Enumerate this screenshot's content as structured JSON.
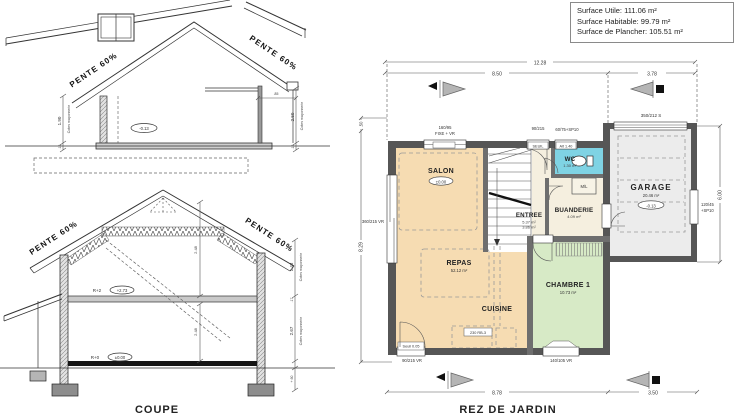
{
  "info_box": {
    "line1": "Surface Utile: 111.06 m²",
    "line2": "Surface Habitable: 99.79 m²",
    "line3": "Surface de Plancher: 105.51 m²"
  },
  "coupe": {
    "title": "COUPE",
    "pente": "PENTE 60%",
    "top": {
      "level": "-0.13",
      "d190": "1.90",
      "d12": ".12",
      "d250": "2.50",
      "d85": ".85",
      "cotes": "Cotes maçonnerie"
    },
    "bot": {
      "r2": "R+2",
      "r2v": "+2.73",
      "r0": "R+0",
      "r0v": "±0.00",
      "d143": "1.43",
      "d267": "2.67",
      "d17": ".17",
      "d60": "+.60",
      "d248": "2.48",
      "cotes": "Cotes maçonnerie"
    }
  },
  "plan": {
    "title": "REZ DE JARDIN",
    "dims": {
      "top_total": "12.28",
      "top_left": "8.50",
      "top_right": "3.78",
      "bottom_left": "8.78",
      "bottom_right": "3.50",
      "left_height": "8.29",
      "left_small": ".50",
      "right_height": "6.00"
    },
    "rooms": {
      "salon": {
        "label": "SALON",
        "level": "±0.00"
      },
      "repas": {
        "label": "REPAS",
        "area": "52.12 m²"
      },
      "cuisine": {
        "label": "CUISINE"
      },
      "entree": {
        "label": "ENTREE",
        "area1": "5.37 m²",
        "area2": "3.86 m²"
      },
      "wc": {
        "label": "WC",
        "area": "1.30 m²"
      },
      "buanderie": {
        "label": "BUANDERIE",
        "area": "4.09 m²"
      },
      "chambre": {
        "label": "CHAMBRE 1",
        "area": "10.73 m²"
      },
      "garage": {
        "label": "GARAGE",
        "area": "20.46 m²",
        "level": "-0.13"
      }
    },
    "open": {
      "top_window1": "160/95",
      "top_window2": "FIXE + VR",
      "entry_door": "90/215",
      "entry_seuil": "SEUIL",
      "wc_window": "60/75+SP10",
      "wc_alt": "Alt 1.40",
      "garage_door": "350/212 S",
      "garage_window1": "120/45",
      "garage_window2": "+SP10",
      "left_window": "360/215 VR",
      "bottom_door": "90/215 VR",
      "bottom_seuil": "Seuil 0.05",
      "chambre_window": "140/105 VR",
      "ml": "M/L",
      "kitchen_note": "230 RB-3"
    }
  }
}
